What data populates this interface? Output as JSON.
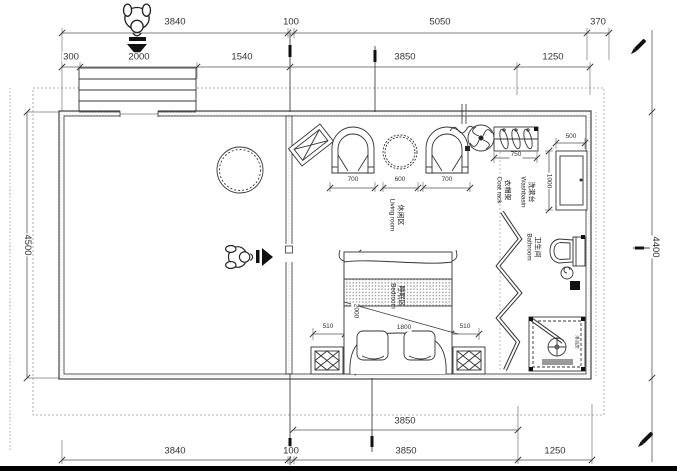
{
  "drawing_type": "floor-plan",
  "dims": {
    "top_row_outer": [
      "3840",
      "100",
      "5050",
      "370"
    ],
    "top_row_inner": [
      "300",
      "2000",
      "1540",
      "3850",
      "1250"
    ],
    "bottom_row_inner": [
      "3850"
    ],
    "bottom_row_outer": [
      "3840",
      "100",
      "3850",
      "1250"
    ],
    "left_side": "4500",
    "right_side": "4400",
    "living_widths": [
      "700",
      "600",
      "700"
    ],
    "coat_rack_width": "750",
    "washbasin_width": "500",
    "washbasin_depth": "1000",
    "bed_side_left": "510",
    "bed_width": "1800",
    "bed_side_right": "510",
    "bed_length": "2000"
  },
  "rooms": {
    "living": {
      "zh": "休闲区",
      "en": "Living room"
    },
    "bedroom": {
      "zh": "睡眠区",
      "en": "Bedroom"
    },
    "bathroom": {
      "zh": "卫生间",
      "en": "Bathroom"
    },
    "coat_rack": {
      "zh": "衣帽架",
      "en": "Coat rack"
    },
    "washbasin": {
      "zh": "洗漱台",
      "en": "Washbasin"
    },
    "shower": {
      "zh": "淋浴房",
      "en": ""
    }
  },
  "icons": {
    "entry_person_top": "person-top-view-icon",
    "entry_arrow_top": "arrow-down-icon",
    "interior_person": "person-top-view-icon",
    "interior_arrow": "arrow-right-icon",
    "annotation_pen_top_right": "pen-icon",
    "annotation_pen_bottom_right": "pen-icon",
    "ceiling_fan": "fan-icon",
    "shower_drain": "drain-icon"
  },
  "colors": {
    "line": "#333333",
    "dim_line": "#555555",
    "dashed_boundary": "#999999",
    "solid_black": "#111111"
  }
}
